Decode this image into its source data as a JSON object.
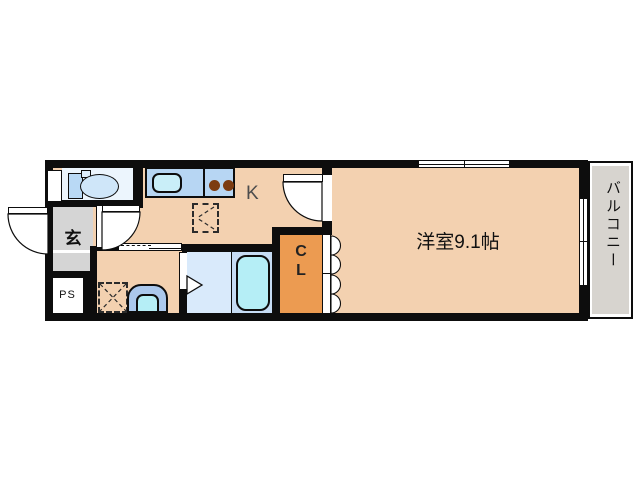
{
  "floorplan": {
    "labels": {
      "entrance": "玄",
      "pipe_space": "PS",
      "kitchen": "K",
      "closet_line1": "C",
      "closet_line2": "L",
      "bedroom": "洋室9.1帖",
      "balcony": "バルコニー"
    },
    "colors": {
      "wall_black": "#0d0d0d",
      "floor_peach": "#f3d1b0",
      "toilet_floor_blue": "#ecf5fd",
      "counter_blue": "#b7d6f3",
      "water_cyan": "#b5eef6",
      "bath_floor_blue": "#d9eafb",
      "tub_surround_blue": "#c6dcf4",
      "basin_blue": "#abc8ec",
      "burner_brown": "#7c3c12",
      "closet_orange": "#ec9b51",
      "entrance_gray": "#d5d5d5",
      "balcony_gray": "#d7d4cf"
    },
    "fixtures": [
      {
        "name": "toilet-icon"
      },
      {
        "name": "kitchen-sink-icon"
      },
      {
        "name": "stove-burners-icon"
      },
      {
        "name": "refrigerator-space-icon"
      },
      {
        "name": "washing-machine-space-icon"
      },
      {
        "name": "wash-basin-icon"
      },
      {
        "name": "bathtub-icon"
      }
    ]
  }
}
